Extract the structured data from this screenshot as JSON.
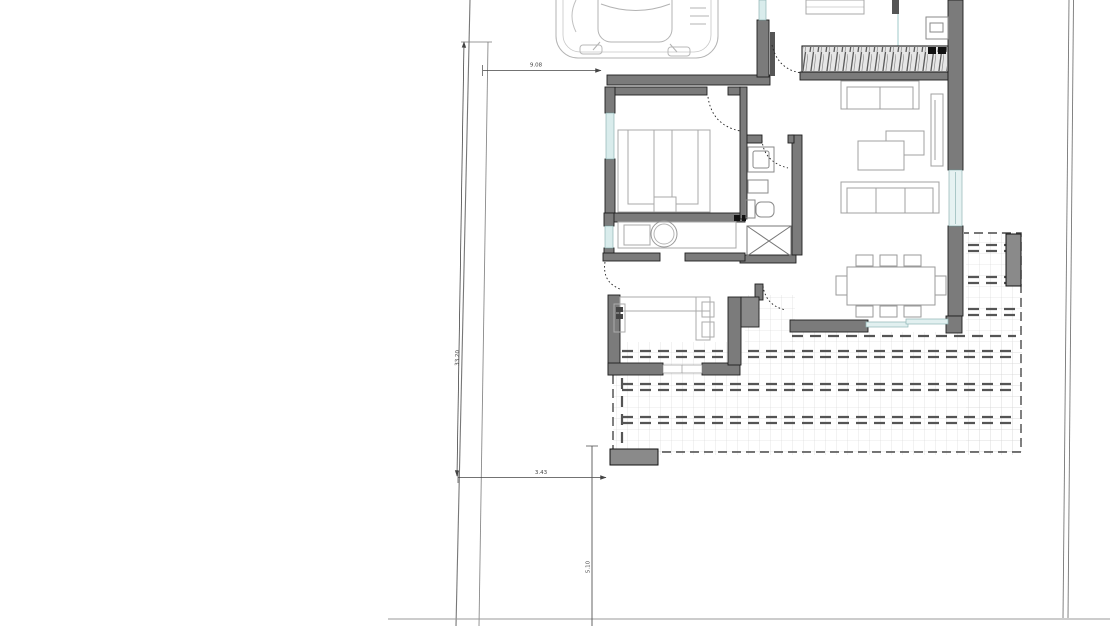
{
  "plan": {
    "dimensions": {
      "top_width": "9.08",
      "left_boundary": "33.20",
      "bottom_offset": "3.43",
      "south_setback": "5.10"
    },
    "colors": {
      "background": "#ffffff",
      "wall_fill": "#7b7b7b",
      "wall_outline": "#1f1f1f",
      "glazing": "#d9ecec",
      "furniture_line": "#a0a0a0",
      "terrace_grid": "#d4d4d4",
      "dashed_pergola": "#555555",
      "boundary_line": "#777777",
      "dimension_line": "#444444"
    }
  }
}
